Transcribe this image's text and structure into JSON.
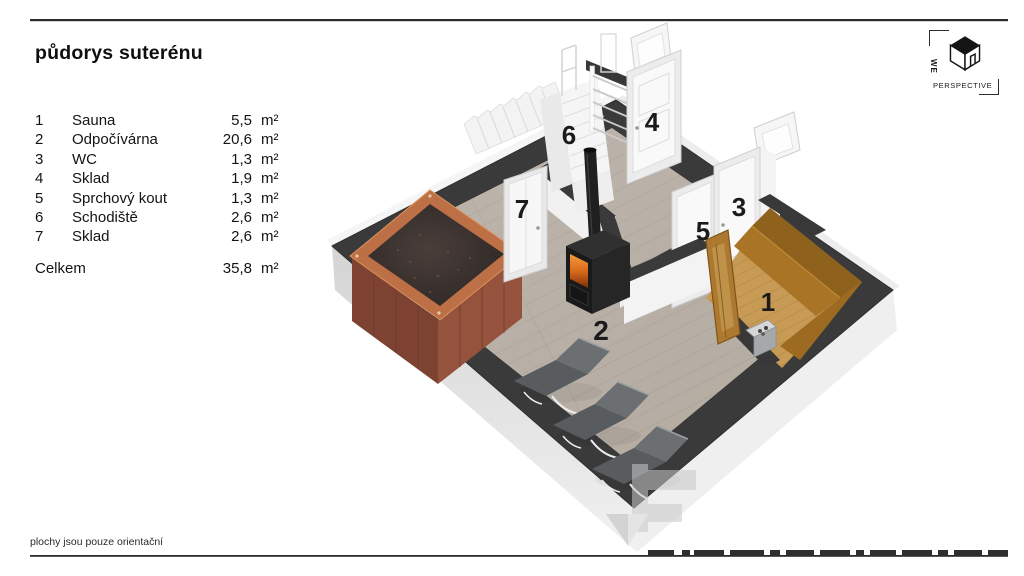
{
  "page": {
    "title": "půdorys suterénu",
    "footnote": "plochy jsou pouze orientační"
  },
  "legend": {
    "rows": [
      {
        "num": "1",
        "name": "Sauna",
        "area": "5,5",
        "unit": "m²"
      },
      {
        "num": "2",
        "name": "Odpočívárna",
        "area": "20,6",
        "unit": "m²"
      },
      {
        "num": "3",
        "name": "WC",
        "area": "1,3",
        "unit": "m²"
      },
      {
        "num": "4",
        "name": "Sklad",
        "area": "1,9",
        "unit": "m²"
      },
      {
        "num": "5",
        "name": "Sprchový kout",
        "area": "1,3",
        "unit": "m²"
      },
      {
        "num": "6",
        "name": "Schodiště",
        "area": "2,6",
        "unit": "m²"
      },
      {
        "num": "7",
        "name": "Sklad",
        "area": "2,6",
        "unit": "m²"
      }
    ],
    "total": {
      "label": "Celkem",
      "area": "35,8",
      "unit": "m²"
    }
  },
  "logo": {
    "word_vertical": "WE",
    "word_main": "PERSPECTIVE"
  },
  "plan": {
    "labels": {
      "r1": "1",
      "r2": "2",
      "r3": "3",
      "r4": "4",
      "r5": "5",
      "r6": "6",
      "r7": "7"
    },
    "colors": {
      "wall": "#3a3a3a",
      "floor": "#b3aaa0",
      "sauna_wood": "#aa7426",
      "tub_wood": "#95523c",
      "fire": "#e07020"
    }
  }
}
